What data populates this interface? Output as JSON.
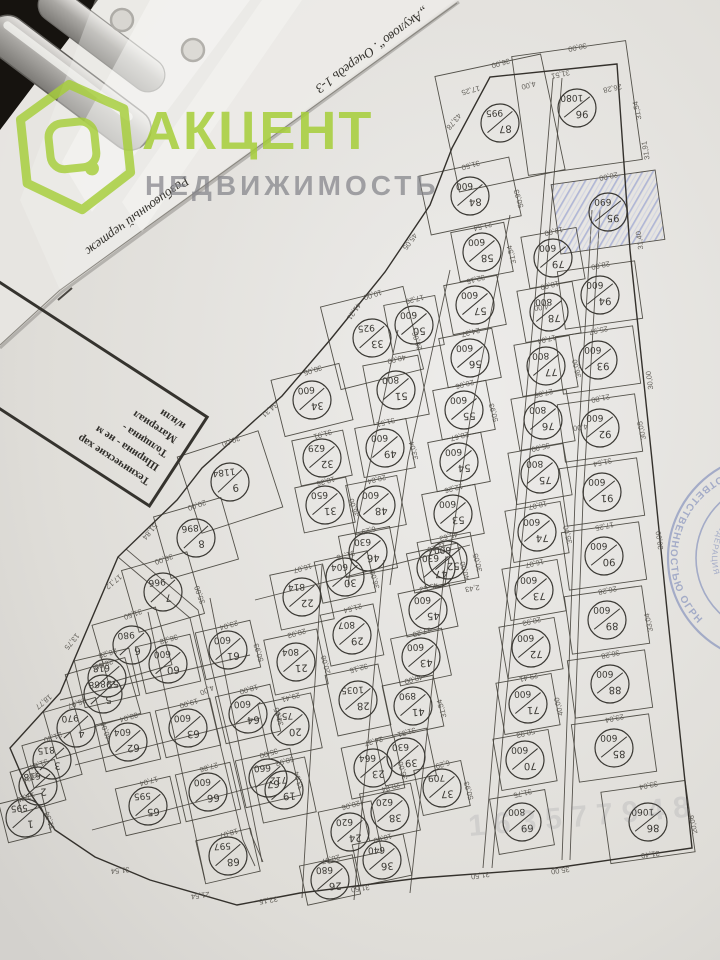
{
  "watermark": {
    "brand": "АКЦЕНТ",
    "sub": "НЕДВИЖИМОСТЬ",
    "green": "#a6ce39",
    "gray": "#84848a",
    "id_number": "163577948"
  },
  "title": {
    "full": "Разбивочный чертеж „Акулово“. Очередь 1-3",
    "part1": "Разбивочный чертеж",
    "part2": "„Акулово“. Очередь 1-3"
  },
  "notes_box": {
    "lines": [
      "Технические хар",
      "Ширина - не м",
      "Толщина - ",
      "Материал ",
      "и/или "
    ]
  },
  "stamp": {
    "outer_text": "ОТВЕТСТВЕННОСТЬЮ   ОГРН",
    "inner_text": "КАЯ ФЕДЕРАЦИЯ",
    "color": "#6f7fb5"
  },
  "map": {
    "line_color": "#47443d",
    "boundary_color": "#34312c",
    "hatch_color": "#98a1d0",
    "label_color": "#3a3833",
    "dim_color": "#55524c",
    "plots": [
      [
        96,
        "1080",
        577,
        108,
        115,
        120,
        -8,
        0
      ],
      [
        95,
        "690",
        608,
        212,
        105,
        70,
        -8,
        1
      ],
      [
        87,
        "995",
        500,
        123,
        108,
        118,
        -12,
        0
      ],
      [
        84,
        "600",
        470,
        196,
        92,
        60,
        -12,
        0
      ],
      [
        94,
        "600",
        600,
        295,
        78,
        58,
        -8,
        0
      ],
      [
        93,
        "600",
        598,
        360,
        78,
        58,
        -8,
        0
      ],
      [
        92,
        "600",
        600,
        428,
        78,
        58,
        -8,
        0
      ],
      [
        91,
        "600",
        602,
        492,
        78,
        58,
        -8,
        0
      ],
      [
        90,
        "600",
        604,
        556,
        78,
        58,
        -8,
        0
      ],
      [
        89,
        "600",
        607,
        620,
        78,
        58,
        -8,
        0
      ],
      [
        88,
        "600",
        610,
        684,
        78,
        58,
        -8,
        0
      ],
      [
        85,
        "600",
        614,
        748,
        78,
        58,
        -8,
        0
      ],
      [
        86,
        "1060",
        648,
        822,
        85,
        72,
        -8,
        0
      ],
      [
        79,
        "600",
        553,
        258,
        56,
        52,
        -10,
        0
      ],
      [
        78,
        "800",
        549,
        312,
        56,
        52,
        -10,
        0
      ],
      [
        77,
        "800",
        546,
        366,
        56,
        52,
        -10,
        0
      ],
      [
        76,
        "800",
        543,
        420,
        56,
        52,
        -10,
        0
      ],
      [
        75,
        "800",
        540,
        474,
        56,
        52,
        -10,
        0
      ],
      [
        74,
        "600",
        537,
        532,
        56,
        52,
        -10,
        0
      ],
      [
        73,
        "600",
        534,
        590,
        56,
        52,
        -10,
        0
      ],
      [
        72,
        "600",
        531,
        648,
        56,
        52,
        -10,
        0
      ],
      [
        71,
        "600",
        528,
        704,
        56,
        52,
        -10,
        0
      ],
      [
        70,
        "600",
        525,
        760,
        56,
        52,
        -10,
        0
      ],
      [
        69,
        "800",
        522,
        822,
        56,
        56,
        -10,
        0
      ],
      [
        58,
        "600",
        482,
        252,
        54,
        50,
        -11,
        0
      ],
      [
        57,
        "600",
        475,
        305,
        54,
        50,
        -11,
        0
      ],
      [
        56,
        "600",
        470,
        358,
        54,
        50,
        -11,
        0
      ],
      [
        55,
        "600",
        464,
        410,
        54,
        50,
        -11,
        0
      ],
      [
        54,
        "600",
        459,
        462,
        54,
        50,
        -11,
        0
      ],
      [
        53,
        "600",
        453,
        514,
        54,
        50,
        -11,
        0
      ],
      [
        52,
        "600",
        448,
        560,
        54,
        46,
        -11,
        0
      ],
      [
        50,
        "600",
        414,
        325,
        52,
        50,
        -11,
        0
      ],
      [
        51,
        "800",
        396,
        390,
        56,
        60,
        -11,
        0
      ],
      [
        49,
        "600",
        385,
        448,
        52,
        50,
        -11,
        0
      ],
      [
        48,
        "600",
        376,
        505,
        52,
        50,
        -11,
        0
      ],
      [
        46,
        "630",
        368,
        552,
        52,
        42,
        -11,
        0
      ],
      [
        33,
        "925",
        372,
        338,
        85,
        85,
        -14,
        0
      ],
      [
        34,
        "600",
        312,
        400,
        70,
        58,
        -14,
        0
      ],
      [
        32,
        "629",
        322,
        458,
        52,
        46,
        -12,
        0
      ],
      [
        31,
        "650",
        325,
        505,
        52,
        46,
        -12,
        0
      ],
      [
        9,
        "1184",
        230,
        482,
        85,
        80,
        -18,
        0
      ],
      [
        8,
        "896",
        196,
        538,
        70,
        64,
        -16,
        0
      ],
      [
        7,
        "966",
        163,
        592,
        68,
        64,
        -16,
        0
      ],
      [
        6,
        "980",
        132,
        645,
        66,
        60,
        -16,
        0
      ],
      [
        5,
        "868",
        103,
        694,
        62,
        58,
        -16,
        0
      ],
      [
        4,
        "970",
        76,
        728,
        54,
        48,
        -16,
        0
      ],
      [
        3,
        "815",
        52,
        760,
        50,
        44,
        -16,
        0
      ],
      [
        2,
        "618",
        38,
        786,
        46,
        42,
        -16,
        0
      ],
      [
        1,
        "595",
        25,
        818,
        44,
        40,
        -14,
        0
      ],
      [
        59,
        "618",
        107,
        678,
        56,
        48,
        -13,
        0
      ],
      [
        60,
        "600",
        168,
        664,
        56,
        48,
        -13,
        0
      ],
      [
        61,
        "600",
        228,
        650,
        56,
        48,
        -13,
        0
      ],
      [
        62,
        "604",
        128,
        742,
        56,
        48,
        -13,
        0
      ],
      [
        63,
        "600",
        188,
        728,
        56,
        48,
        -13,
        0
      ],
      [
        64,
        "600",
        248,
        714,
        56,
        48,
        -13,
        0
      ],
      [
        65,
        "595",
        148,
        806,
        56,
        48,
        -13,
        0
      ],
      [
        66,
        "600",
        208,
        792,
        56,
        48,
        -13,
        0
      ],
      [
        67,
        "660",
        268,
        778,
        56,
        48,
        -13,
        0
      ],
      [
        68,
        "597",
        228,
        856,
        56,
        44,
        -13,
        0
      ],
      [
        22,
        "814",
        302,
        597,
        54,
        56,
        -12,
        0
      ],
      [
        21,
        "804",
        296,
        662,
        54,
        56,
        -12,
        0
      ],
      [
        20,
        "751",
        290,
        726,
        54,
        56,
        -12,
        0
      ],
      [
        19,
        "712",
        284,
        790,
        54,
        56,
        -12,
        0
      ],
      [
        30,
        "604",
        345,
        577,
        54,
        42,
        -12,
        0
      ],
      [
        29,
        "807",
        352,
        635,
        54,
        52,
        -12,
        0
      ],
      [
        28,
        "1035",
        358,
        700,
        54,
        62,
        -12,
        0
      ],
      [
        23,
        "664",
        373,
        768,
        54,
        52,
        -12,
        0
      ],
      [
        24,
        "620",
        350,
        832,
        54,
        52,
        -12,
        0
      ],
      [
        26,
        "680",
        330,
        880,
        54,
        40,
        -12,
        0
      ],
      [
        47,
        "630",
        436,
        568,
        52,
        40,
        -12,
        0
      ],
      [
        45,
        "600",
        428,
        610,
        52,
        44,
        -12,
        0
      ],
      [
        43,
        "600",
        421,
        657,
        52,
        48,
        -12,
        0
      ],
      [
        41,
        "890",
        413,
        706,
        52,
        52,
        -12,
        0
      ],
      [
        39,
        "630",
        406,
        757,
        52,
        48,
        -12,
        0
      ],
      [
        38,
        "620",
        390,
        812,
        52,
        48,
        -12,
        0
      ],
      [
        37,
        "709",
        442,
        788,
        48,
        46,
        -12,
        0
      ],
      [
        36,
        "640",
        382,
        860,
        52,
        42,
        -12,
        0
      ]
    ],
    "dims": [
      "30,00",
      "20,00",
      "36,00",
      "31,50",
      "28,00",
      "25,97",
      "21,80",
      "31,54",
      "17,25",
      "26,28",
      "36,28",
      "23,04",
      "33,04",
      "19,00",
      "18,00",
      "17,04",
      "27,86",
      "35,00",
      "18,07",
      "16,07",
      "20,93",
      "29,41",
      "50,93",
      "31,75",
      "21,54",
      "32,15",
      "24,37",
      "20,06",
      "28,67",
      "12,26",
      "45,63",
      "17,29",
      "40,00",
      "31,51",
      "20,84",
      "6,29",
      "10,00",
      "30,05",
      "31,91",
      "18,36"
    ],
    "edge_dims": [
      {
        "t": "17,25",
        "x": 470,
        "y": 88,
        "r": 165
      },
      {
        "t": "4,00",
        "x": 528,
        "y": 83,
        "r": 165
      },
      {
        "t": "31,51",
        "x": 560,
        "y": 72,
        "r": 168
      },
      {
        "t": "26,28",
        "x": 612,
        "y": 86,
        "r": 168
      },
      {
        "t": "31,91",
        "x": 648,
        "y": 150,
        "r": 260
      },
      {
        "t": "31,40",
        "x": 642,
        "y": 240,
        "r": 262
      },
      {
        "t": "30,00",
        "x": 652,
        "y": 380,
        "r": 262
      },
      {
        "t": "30,00",
        "x": 662,
        "y": 540,
        "r": 262
      },
      {
        "t": "43,78",
        "x": 452,
        "y": 120,
        "r": 130
      },
      {
        "t": "45,05",
        "x": 408,
        "y": 240,
        "r": 127
      },
      {
        "t": "41,21",
        "x": 352,
        "y": 310,
        "r": 125
      },
      {
        "t": "34,31",
        "x": 268,
        "y": 408,
        "r": 140
      },
      {
        "t": "51,84",
        "x": 148,
        "y": 530,
        "r": 130
      },
      {
        "t": "17,12",
        "x": 112,
        "y": 580,
        "r": 140
      },
      {
        "t": "13,75",
        "x": 70,
        "y": 640,
        "r": 130
      },
      {
        "t": "18,77",
        "x": 42,
        "y": 700,
        "r": 140
      },
      {
        "t": "33,04",
        "x": 30,
        "y": 775,
        "r": 150
      },
      {
        "t": "31,54",
        "x": 120,
        "y": 868,
        "r": 175
      },
      {
        "t": "21,54",
        "x": 200,
        "y": 893,
        "r": 172
      },
      {
        "t": "32,15",
        "x": 268,
        "y": 898,
        "r": 170
      },
      {
        "t": "31,50",
        "x": 360,
        "y": 886,
        "r": 172
      },
      {
        "t": "31,50",
        "x": 480,
        "y": 873,
        "r": 172
      },
      {
        "t": "35,00",
        "x": 560,
        "y": 868,
        "r": 172
      },
      {
        "t": "31,40",
        "x": 650,
        "y": 852,
        "r": 172
      }
    ],
    "road_labels": [
      {
        "t": "4,00",
        "x": 541,
        "y": 305,
        "r": 172
      },
      {
        "t": "4,00",
        "x": 580,
        "y": 425,
        "r": 172
      },
      {
        "t": "2,43",
        "x": 472,
        "y": 586,
        "r": 170
      },
      {
        "t": "4,00",
        "x": 206,
        "y": 688,
        "r": 156
      }
    ]
  }
}
